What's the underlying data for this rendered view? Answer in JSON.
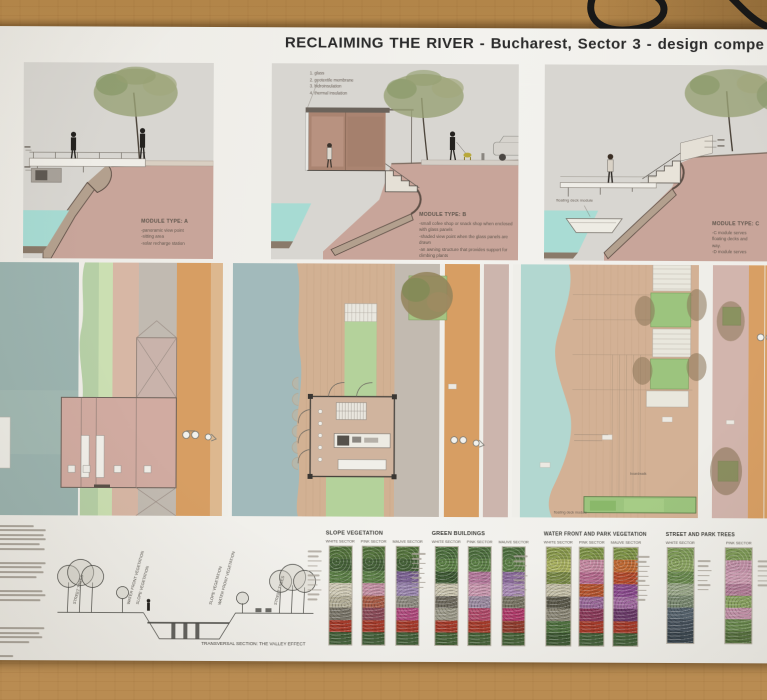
{
  "poster": {
    "title": "RECLAIMING THE RIVER - Bucharest, Sector 3 - design compe",
    "modules": {
      "a": {
        "label": "MODULE TYPE: A",
        "lines": [
          "-panoramic view point",
          "-sitting area",
          "-solar recharge station"
        ]
      },
      "b": {
        "label": "MODULE TYPE: B",
        "legend": [
          "1. glass",
          "2. geotextile membrane",
          "3. hidroinsulation",
          "4. thermal insulation"
        ],
        "lines": [
          "-small cofee shop or snack shop when enclosed with glass panels",
          "-shaded view point when the glass panels are drawn",
          "-an awning structure that provides support for climbing plants"
        ]
      },
      "c": {
        "label": "MODULE TYPE: C",
        "lines": [
          "-C module serves",
          "floating decks and",
          "way.",
          "-D module serves"
        ],
        "floating_deck_label": "floating deck module"
      }
    },
    "plans": {
      "boardwalk_label": "boardwalk",
      "floating_deck_label": "floating deck module"
    },
    "transversal": {
      "caption": "TRANSVERSAL SECTION: THE VALLEY EFFECT",
      "rotated_labels": [
        "STREET TREES",
        "WATER FRONT VEGETATION",
        "SLOPE VEGETATION",
        "SLOPE VEGETATION",
        "WATER FRONT VEGETATION",
        "STREET TREES"
      ]
    },
    "veg": {
      "groups": [
        {
          "title": "SLOPE VEGETATION",
          "sectors": [
            "WHITE SECTOR",
            "PINK SECTOR",
            "MAUVE SECTOR"
          ]
        },
        {
          "title": "GREEN BUILDINGS",
          "sectors": [
            "WHITE SECTOR",
            "PINK SECTOR",
            "MAUVE SECTOR"
          ]
        },
        {
          "title": "WATER FRONT AND PARK  VEGETATION",
          "sectors": [
            "WHITE SECTOR",
            "PINK SECTOR",
            "MAUVE SECTOR"
          ]
        },
        {
          "title": "STREET  AND PARK  TREES",
          "sectors": [
            "WHITE SECTOR",
            "PINK SECTOR"
          ]
        }
      ],
      "palettes": {
        "slope": [
          [
            "#55743e",
            "#47633a",
            "#5d8048",
            "#cfcab6",
            "#b3ae98",
            "#7a766a",
            "#a53a2a",
            "#43603a"
          ],
          [
            "#55743e",
            "#47633a",
            "#5d8048",
            "#c490a4",
            "#a65b46",
            "#8a4a58",
            "#a53a2a",
            "#43603a"
          ],
          [
            "#55743e",
            "#47633a",
            "#7b6292",
            "#9a86ae",
            "#8d8a80",
            "#b04a7e",
            "#a53a2a",
            "#43603a"
          ]
        ],
        "buildings": [
          [
            "#4f7040",
            "#5d8048",
            "#3f5a35",
            "#c8c3ae",
            "#6e6a5e",
            "#9c9a8a",
            "#a53a2a",
            "#47633a"
          ],
          [
            "#4f7040",
            "#5d8048",
            "#b2779a",
            "#c897ae",
            "#9a8aa0",
            "#b04a6a",
            "#a53a2a",
            "#47633a"
          ],
          [
            "#4f7040",
            "#5d8048",
            "#8a6a9a",
            "#a88ab4",
            "#777463",
            "#b03a6a",
            "#8f3b2d",
            "#47633a"
          ]
        ],
        "waterfront": [
          [
            "#8a9a4e",
            "#a8b060",
            "#7a8a48",
            "#c4bfa8",
            "#5c5a4c",
            "#8c8878",
            "#4f7040",
            "#3f5a35"
          ],
          [
            "#7f9448",
            "#c58aa2",
            "#b56a8e",
            "#b5542e",
            "#9a6a9a",
            "#8a3a5a",
            "#a53a2a",
            "#43603a"
          ],
          [
            "#7f9448",
            "#c06a34",
            "#b44a2c",
            "#8a4a8e",
            "#a06aa0",
            "#6a3a6a",
            "#a53a2a",
            "#43603a"
          ]
        ],
        "trees": [
          [
            "#7e9a58",
            "#8aa462",
            "#6a8a50",
            "#9aa88a",
            "#7a8a72",
            "#55636e",
            "#46525e",
            "#3a4650"
          ],
          [
            "#7e9a58",
            "#c493ab",
            "#cf9fb5",
            "#b47e9a",
            "#8aa462",
            "#c493ab",
            "#6a8a50",
            "#55703f"
          ]
        ]
      }
    },
    "colors": {
      "wood": "#bb9158",
      "section_water": "#a7dbd3",
      "soil": "#c8a59a",
      "plan_water": "#9cb4b0",
      "deck": "#d3b195",
      "road": "#d79e63",
      "lawn": "#b4d29b",
      "pink_pavement": "#d2b5ad"
    }
  }
}
